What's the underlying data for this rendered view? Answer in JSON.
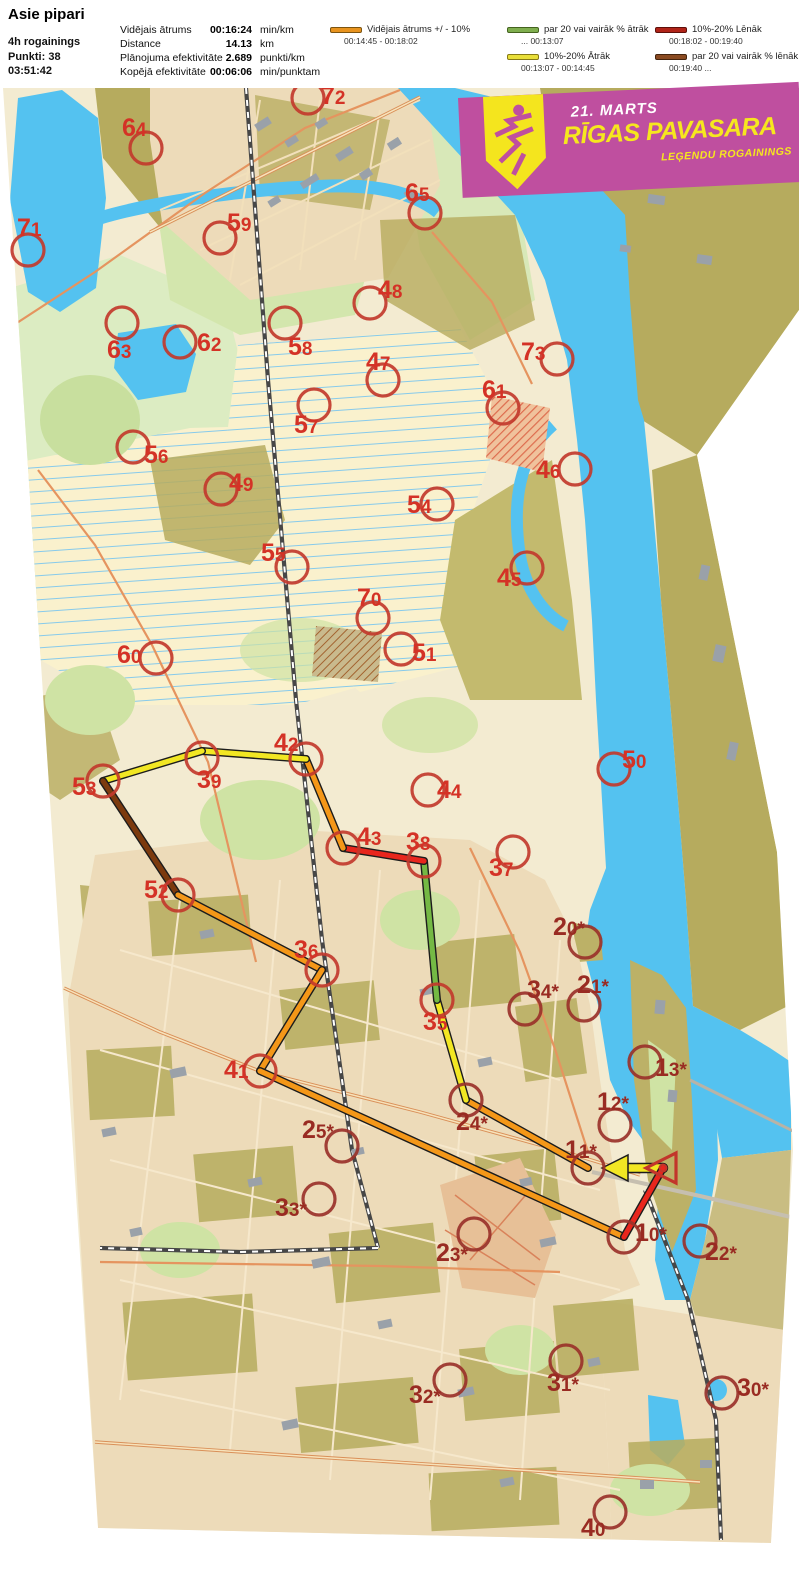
{
  "header": {
    "title": "Asie pipari",
    "lines": [
      "4h rogainings",
      "Punkti: 38",
      "03:51:42"
    ],
    "stats": [
      {
        "label": "Vidējais ātrums",
        "value": "00:16:24",
        "unit": "min/km"
      },
      {
        "label": "Distance",
        "value": "14.13",
        "unit": "km"
      },
      {
        "label": "Plānojuma efektivitāte",
        "value": "2.689",
        "unit": "punkti/km"
      },
      {
        "label": "Kopējā efektivitāte",
        "value": "00:06:06",
        "unit": "min/punktam"
      }
    ]
  },
  "legend": {
    "items": [
      {
        "color": "#e8931e",
        "border": "#7c5410",
        "label": "Vidējais ātrums +/ - 10%",
        "range": "00:14:45  -  00:18:02"
      },
      {
        "color": "#7fae4e",
        "border": "#44631f",
        "label": "par 20 vai vairāk % ātrāk",
        "range": "...    00:13:07"
      },
      {
        "color": "#e9df39",
        "border": "#877a15",
        "label": "10%-20% Ātrāk",
        "range": "00:13:07  -  00:14:45"
      },
      {
        "color": "#b02318",
        "border": "#5e0f0a",
        "label": "10%-20% Lēnāk",
        "range": "00:18:02  -  00:19:40"
      },
      {
        "color": "#8a4a21",
        "border": "#44240e",
        "label": "par 20 vai vairāk % lēnāk",
        "range": "00:19:40  ..."
      }
    ]
  },
  "banner": {
    "date": "21. MARTS",
    "title": "RĪGAS PAVASARA",
    "subtitle": "LEĢENDU ROGAININGS",
    "bg": "#bf4f9f",
    "accent": "#f6e71e"
  },
  "map": {
    "tones": {
      "b": "#d43226",
      "d": "#992b22"
    },
    "circle_strokes": {
      "b": "#c23a2c",
      "d": "#9a322a"
    },
    "palette": {
      "yellow": "#f2e723",
      "orange": "#f49718",
      "green": "#74b944",
      "red": "#e8261d",
      "brown": "#7c3a0e"
    },
    "start": {
      "x": 663,
      "y": 1168
    },
    "route": {
      "points": [
        [
          663,
          1168
        ],
        [
          588,
          1168
        ],
        [
          466,
          1100
        ],
        [
          437,
          1000
        ],
        [
          424,
          861
        ],
        [
          343,
          848
        ],
        [
          306,
          759
        ],
        [
          202,
          751
        ],
        [
          103,
          781
        ],
        [
          178,
          895
        ],
        [
          322,
          970
        ],
        [
          260,
          1071
        ],
        [
          624,
          1237
        ],
        [
          663,
          1168
        ]
      ],
      "leg_colors": [
        "yellow",
        "orange",
        "yellow",
        "green",
        "red",
        "orange",
        "yellow",
        "yellow",
        "brown",
        "orange",
        "orange",
        "orange",
        "red"
      ],
      "arrow_leg": 0
    },
    "controls": [
      {
        "id": "72",
        "x": 308,
        "y": 98,
        "lx": 321,
        "ly": 104,
        "t": "b"
      },
      {
        "id": "64",
        "x": 146,
        "y": 148,
        "lx": 122,
        "ly": 136,
        "t": "b"
      },
      {
        "id": "65",
        "x": 425,
        "y": 213,
        "lx": 405,
        "ly": 201,
        "t": "b"
      },
      {
        "id": "71",
        "x": 28,
        "y": 250,
        "lx": 17,
        "ly": 236,
        "t": "b"
      },
      {
        "id": "59",
        "x": 220,
        "y": 238,
        "lx": 227,
        "ly": 231,
        "t": "b"
      },
      {
        "id": "48",
        "x": 370,
        "y": 303,
        "lx": 378,
        "ly": 298,
        "t": "b"
      },
      {
        "id": "63",
        "x": 122,
        "y": 323,
        "lx": 107,
        "ly": 358,
        "t": "b"
      },
      {
        "id": "62",
        "x": 180,
        "y": 342,
        "lx": 197,
        "ly": 351,
        "t": "b"
      },
      {
        "id": "58",
        "x": 285,
        "y": 323,
        "lx": 288,
        "ly": 355,
        "t": "b"
      },
      {
        "id": "47",
        "x": 383,
        "y": 380,
        "lx": 366,
        "ly": 370,
        "t": "b"
      },
      {
        "id": "73",
        "x": 557,
        "y": 359,
        "lx": 521,
        "ly": 360,
        "t": "b"
      },
      {
        "id": "61",
        "x": 503,
        "y": 408,
        "lx": 482,
        "ly": 398,
        "t": "b"
      },
      {
        "id": "57",
        "x": 314,
        "y": 405,
        "lx": 294,
        "ly": 433,
        "t": "b"
      },
      {
        "id": "56",
        "x": 133,
        "y": 447,
        "lx": 144,
        "ly": 463,
        "t": "b"
      },
      {
        "id": "49",
        "x": 221,
        "y": 489,
        "lx": 229,
        "ly": 491,
        "t": "b"
      },
      {
        "id": "46",
        "x": 575,
        "y": 469,
        "lx": 536,
        "ly": 478,
        "t": "b"
      },
      {
        "id": "54",
        "x": 437,
        "y": 504,
        "lx": 407,
        "ly": 513,
        "t": "b"
      },
      {
        "id": "55",
        "x": 292,
        "y": 567,
        "lx": 261,
        "ly": 561,
        "t": "b"
      },
      {
        "id": "45",
        "x": 527,
        "y": 568,
        "lx": 497,
        "ly": 586,
        "t": "b"
      },
      {
        "id": "70",
        "x": 373,
        "y": 618,
        "lx": 357,
        "ly": 606,
        "t": "b"
      },
      {
        "id": "51",
        "x": 401,
        "y": 649,
        "lx": 412,
        "ly": 661,
        "t": "b"
      },
      {
        "id": "60",
        "x": 156,
        "y": 658,
        "lx": 117,
        "ly": 663,
        "t": "b"
      },
      {
        "id": "50",
        "x": 614,
        "y": 769,
        "lx": 622,
        "ly": 768,
        "t": "b"
      },
      {
        "id": "42",
        "x": 306,
        "y": 759,
        "lx": 274,
        "ly": 751,
        "t": "b"
      },
      {
        "id": "39",
        "x": 202,
        "y": 758,
        "lx": 197,
        "ly": 788,
        "t": "b"
      },
      {
        "id": "53",
        "x": 103,
        "y": 781,
        "lx": 72,
        "ly": 795,
        "t": "b"
      },
      {
        "id": "44",
        "x": 428,
        "y": 790,
        "lx": 437,
        "ly": 798,
        "t": "b"
      },
      {
        "id": "43",
        "x": 343,
        "y": 848,
        "lx": 357,
        "ly": 845,
        "t": "b"
      },
      {
        "id": "38",
        "x": 424,
        "y": 861,
        "lx": 406,
        "ly": 850,
        "t": "b"
      },
      {
        "id": "37",
        "x": 513,
        "y": 852,
        "lx": 489,
        "ly": 876,
        "t": "b"
      },
      {
        "id": "52",
        "x": 178,
        "y": 895,
        "lx": 144,
        "ly": 898,
        "t": "b"
      },
      {
        "id": "20*",
        "x": 585,
        "y": 942,
        "lx": 553,
        "ly": 935,
        "t": "d"
      },
      {
        "id": "36",
        "x": 322,
        "y": 970,
        "lx": 294,
        "ly": 958,
        "t": "b"
      },
      {
        "id": "34*",
        "x": 525,
        "y": 1009,
        "lx": 527,
        "ly": 998,
        "t": "d"
      },
      {
        "id": "21*",
        "x": 584,
        "y": 1005,
        "lx": 577,
        "ly": 993,
        "t": "d"
      },
      {
        "id": "35",
        "x": 437,
        "y": 1000,
        "lx": 423,
        "ly": 1030,
        "t": "b"
      },
      {
        "id": "13*",
        "x": 645,
        "y": 1062,
        "lx": 655,
        "ly": 1076,
        "t": "d"
      },
      {
        "id": "41",
        "x": 260,
        "y": 1071,
        "lx": 224,
        "ly": 1078,
        "t": "b"
      },
      {
        "id": "12*",
        "x": 615,
        "y": 1125,
        "lx": 597,
        "ly": 1110,
        "t": "d"
      },
      {
        "id": "24*",
        "x": 466,
        "y": 1100,
        "lx": 456,
        "ly": 1130,
        "t": "d"
      },
      {
        "id": "25*",
        "x": 342,
        "y": 1146,
        "lx": 302,
        "ly": 1138,
        "t": "d"
      },
      {
        "id": "11*",
        "x": 588,
        "y": 1168,
        "lx": 565,
        "ly": 1158,
        "t": "d"
      },
      {
        "id": "33*",
        "x": 319,
        "y": 1199,
        "lx": 275,
        "ly": 1216,
        "t": "d"
      },
      {
        "id": "10*",
        "x": 624,
        "y": 1237,
        "lx": 635,
        "ly": 1241,
        "t": "d"
      },
      {
        "id": "23*",
        "x": 474,
        "y": 1234,
        "lx": 436,
        "ly": 1261,
        "t": "d"
      },
      {
        "id": "22*",
        "x": 700,
        "y": 1241,
        "lx": 705,
        "ly": 1260,
        "t": "d"
      },
      {
        "id": "32*",
        "x": 450,
        "y": 1380,
        "lx": 409,
        "ly": 1403,
        "t": "d"
      },
      {
        "id": "31*",
        "x": 566,
        "y": 1361,
        "lx": 547,
        "ly": 1391,
        "t": "d"
      },
      {
        "id": "30*",
        "x": 722,
        "y": 1393,
        "lx": 737,
        "ly": 1396,
        "t": "d"
      },
      {
        "id": "40",
        "x": 610,
        "y": 1512,
        "lx": 581,
        "ly": 1536,
        "t": "d"
      }
    ]
  }
}
